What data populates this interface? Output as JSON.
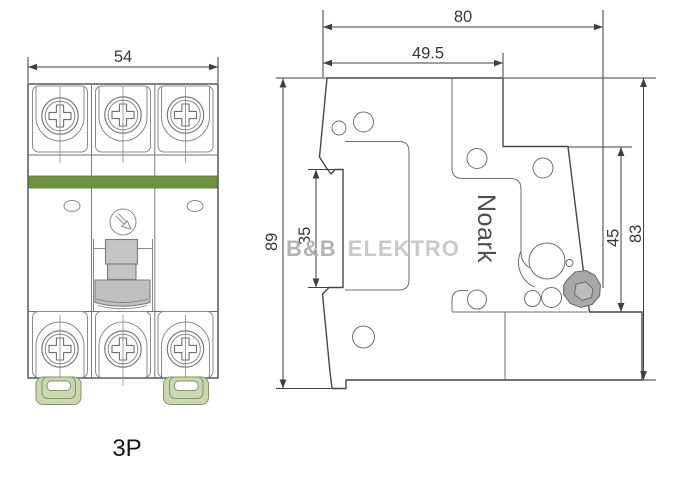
{
  "views": {
    "front": {
      "pole_label": "3P",
      "dim_width": "54"
    },
    "side": {
      "brand_text": "Noark",
      "dim_depth_total": "80",
      "dim_depth_top": "49.5",
      "dim_height_overall": "89",
      "dim_rail_recess": "35",
      "dim_front_section": "45",
      "dim_height_body": "83"
    }
  },
  "watermark": {
    "brand_bold": "B&B",
    "brand_light": "ELEKTRO"
  },
  "colors": {
    "green_band": "#6e9240",
    "clip_fill": "#cbd7ae",
    "lever_fill": "#a8a8a8",
    "lever_inner": "#bdbdbd",
    "toggle_fill": "#c4c4c4",
    "knob_fill": "#bfbfbf"
  }
}
